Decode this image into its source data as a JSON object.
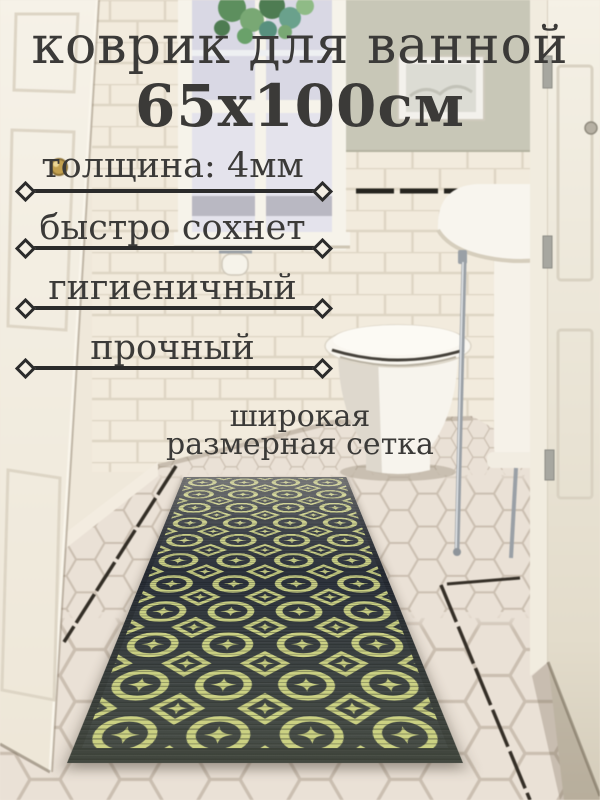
{
  "product_overlay": {
    "title": "коврик для ванной",
    "size": "65x100см",
    "features": [
      "толщина: 4мм",
      "быстро сохнет",
      "гигиеничный",
      "прочный"
    ],
    "note_line1": "широкая",
    "note_line2": "размерная сетка"
  },
  "palette": {
    "overlay-text": "#3b3a38",
    "overlay-line": "#2b2b2b",
    "mat-dark": "#2d333c",
    "mat-accent": "#c9cf83",
    "wall-sage": "#c8c7b7",
    "tile-cream": "#f2ebdd",
    "floor-tile": "#e9dfd4",
    "door-cream": "#f5f1e6",
    "brass-knob": "#c3a14f",
    "chrome": "#9aa0a6",
    "plant-green": "#6f9a64"
  }
}
